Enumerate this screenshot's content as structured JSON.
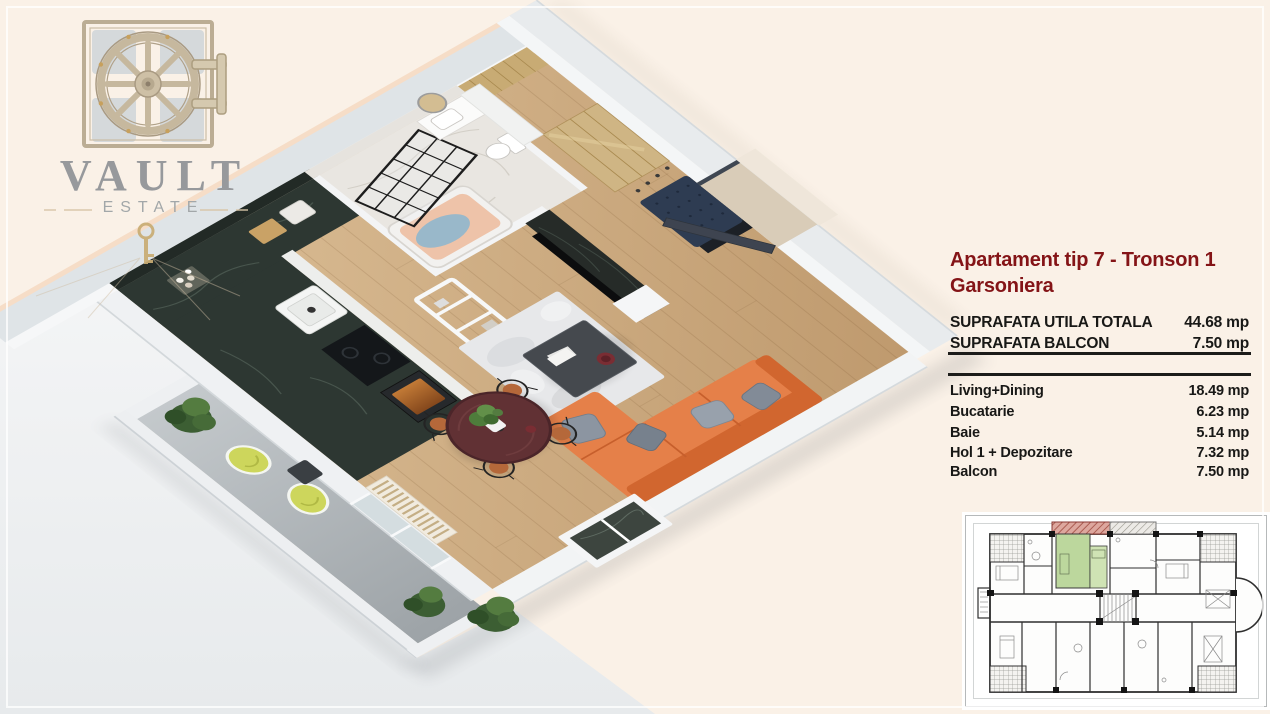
{
  "meta": {
    "type": "real-estate-floorplan-card"
  },
  "background": {
    "canvas": "#faf1e7",
    "ground": "#f0f2f4"
  },
  "logo": {
    "title": "VAULT",
    "subtitle": "ESTATE",
    "icon": "vault-door-icon",
    "accent_gold": "#c9ad74",
    "text_color": "#97999c"
  },
  "panel": {
    "title_line1": "Apartament tip 7 - Tronson 1",
    "title_line2": "Garsoniera",
    "title_color": "#841417",
    "summary": [
      {
        "label": "SUPRAFATA UTILA TOTALA",
        "value": "44.68 mp"
      },
      {
        "label": "SUPRAFATA BALCON",
        "value": "7.50 mp"
      }
    ],
    "rooms": [
      {
        "label": "Living+Dining",
        "value": "18.49 mp"
      },
      {
        "label": "Bucatarie",
        "value": "6.23 mp"
      },
      {
        "label": "Baie",
        "value": "5.14 mp"
      },
      {
        "label": "Hol 1 + Depozitare",
        "value": "7.32 mp"
      },
      {
        "label": "Balcon",
        "value": "7.50 mp"
      }
    ]
  },
  "floorplan_3d": {
    "sofa_color": "#e58049",
    "kitchen_marble_color": "#2d3732",
    "wood_floor_color": "#cfa97c",
    "balcony_chair_color": "#cdd65c",
    "bathtub_color": "#eec3a9",
    "entry_door_color": "#3e4450",
    "rug_color": "#e7e8ea"
  },
  "mini_plan": {
    "highlight_unit_color": "#bcd79d",
    "highlight_balcony_color": "#c98d85",
    "linework_color": "#2f2f2f"
  }
}
